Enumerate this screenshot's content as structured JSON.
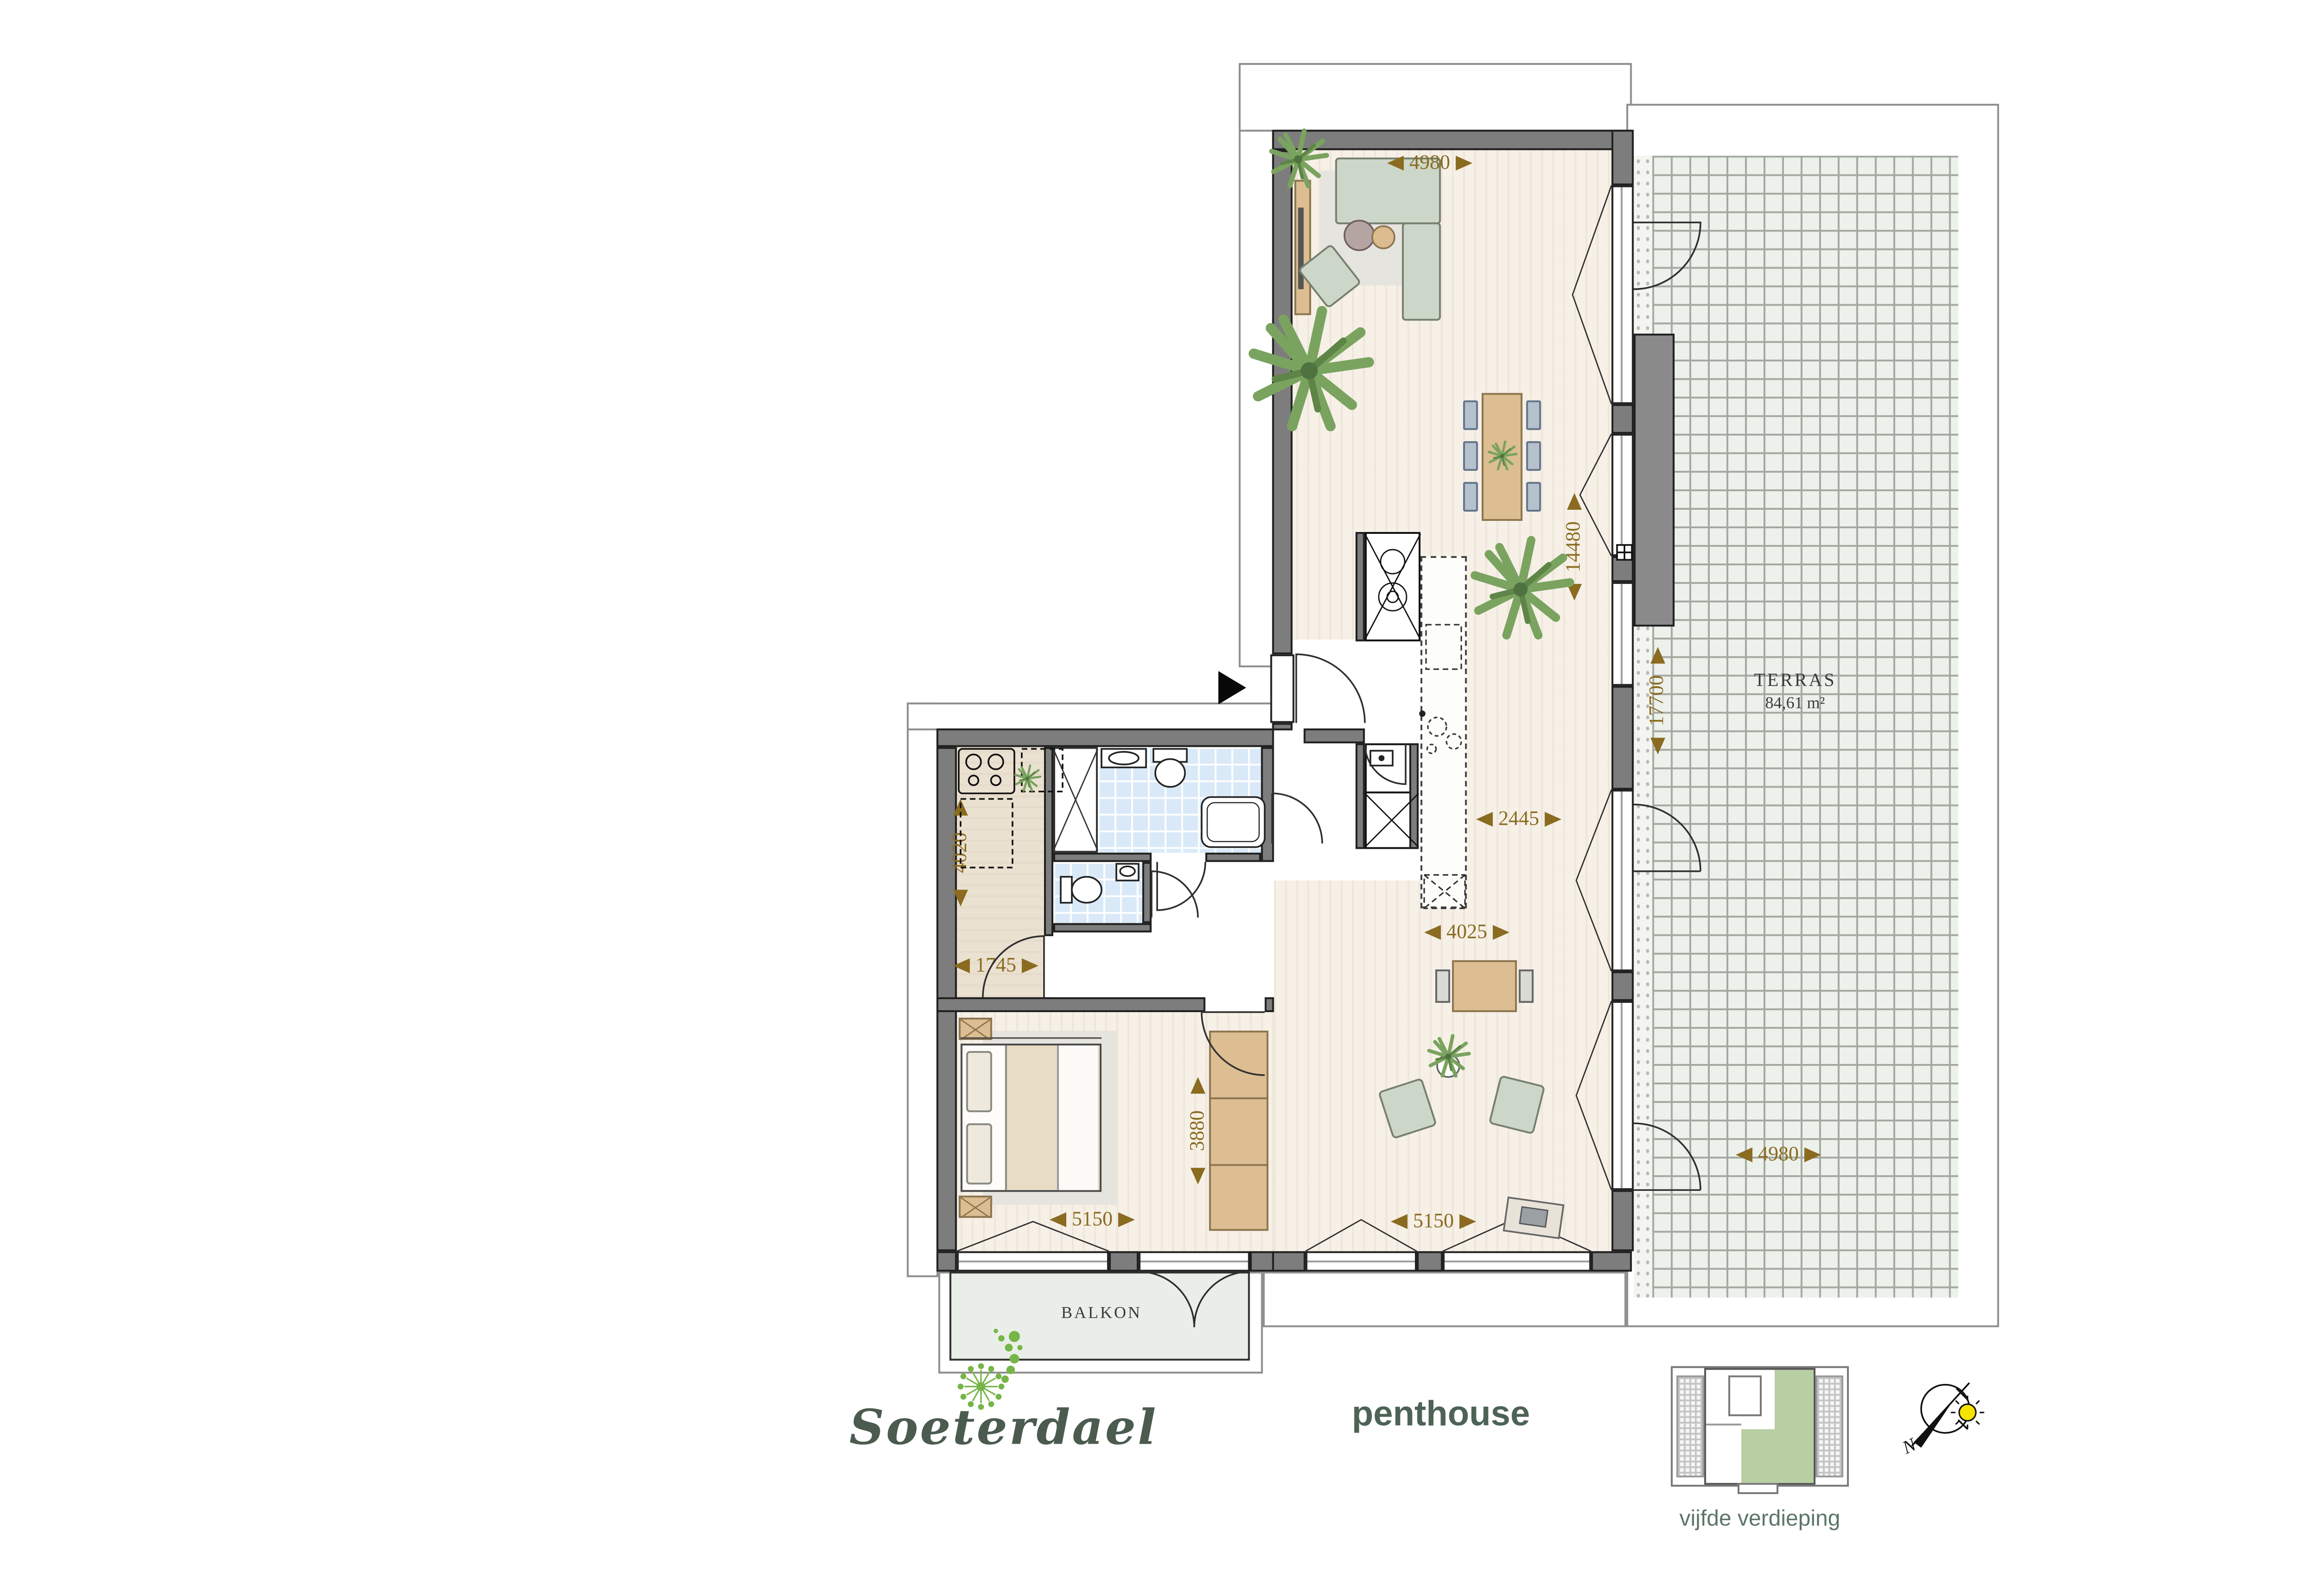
{
  "branding": {
    "logo_text": "Soeterdael",
    "unit_label": "penthouse",
    "floor_label": "vijfde verdieping"
  },
  "rooms": {
    "terrace_name": "TERRAS",
    "terrace_area": "84,61 m²",
    "balcony_name": "BALKON"
  },
  "compass": {
    "north_label": "N"
  },
  "dimensions": {
    "living_width_top": "4980",
    "living_length": "14480",
    "terrace_length": "17700",
    "terrace_width": "4980",
    "kitchen_passage": "2445",
    "lounge_width": "4025",
    "utility_length": "4020",
    "utility_width": "1745",
    "wardrobe_length": "3880",
    "bedroom_width": "5150",
    "living_width_bottom": "5150"
  },
  "colors": {
    "dimension_text": "#8a6b20",
    "logo_green": "#4b5b4f",
    "logo_dot_green": "#76b547",
    "wall_gray": "#7d7d7d",
    "terrace_tile": "#edf1ec",
    "bath_tile": "#d9e9f7",
    "unit_highlight": "#b7cfa3",
    "sun_yellow": "#f5e400"
  }
}
